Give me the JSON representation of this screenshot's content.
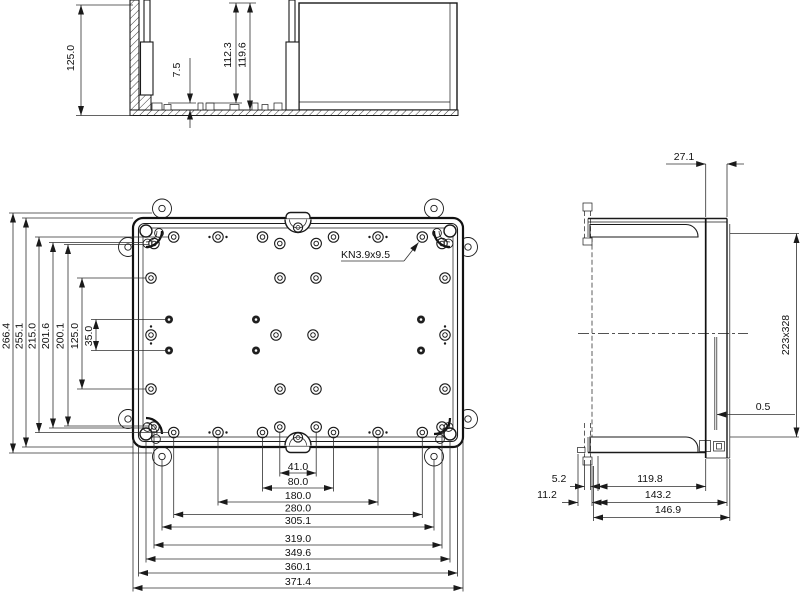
{
  "kn_label": "KN3.9x9.5",
  "section_view": {
    "overall_height": "125.0",
    "standoff_height": "7.5",
    "depth_to_boss": "112.3",
    "inner_depth": "119.6"
  },
  "top_view": {
    "vertical": {
      "overall": "266.4",
      "body": "255.1",
      "boss_span": "215.0",
      "outer_pair": "201.6",
      "inner_pair": "200.1",
      "mid_span": "125.0",
      "center_pair": "35.0"
    },
    "horizontal": {
      "d41": "41.0",
      "d80": "80.0",
      "d180": "180.0",
      "d280": "280.0",
      "d305": "305.1",
      "d319": "319.0",
      "d349": "349.6",
      "d360": "360.1",
      "d371": "371.4"
    }
  },
  "side_view": {
    "flange_depth": "27.1",
    "panel_size": "223x328",
    "gap": "0.5",
    "lug_offset": "5.2",
    "lug_offset2": "11.2",
    "body_depth": "119.8",
    "depth_with_cover": "143.2",
    "overall_depth": "146.9"
  }
}
